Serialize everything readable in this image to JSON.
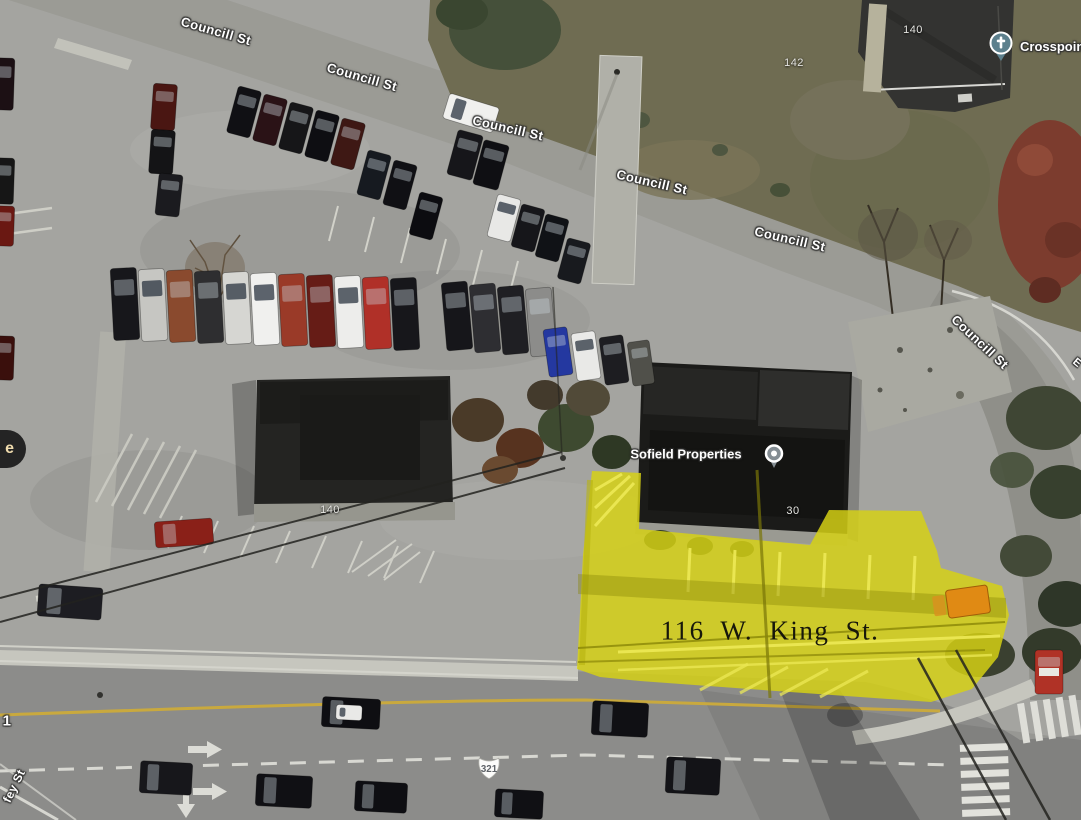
{
  "app": {
    "type": "satellite-map-view"
  },
  "highlight": {
    "label": "116 W. King St.",
    "label_x": 770,
    "label_y": 631,
    "fill": "#d6d214",
    "accent": "#e08a14"
  },
  "pois": [
    {
      "name": "Crosspoint",
      "icon": "church-pin",
      "pin_x": 988,
      "pin_y": 31,
      "label_x": 1020,
      "label_y": 39
    },
    {
      "name": "Sofield Properties",
      "icon": "place-pin",
      "pin_x": 764,
      "pin_y": 444,
      "label_x": 686,
      "label_y": 454
    }
  ],
  "route_badge": {
    "text": "321",
    "shape": "us-route-shield",
    "x": 475,
    "y": 755
  },
  "street_labels": [
    {
      "text": "Councill St",
      "x": 216,
      "y": 31,
      "rot": 16
    },
    {
      "text": "Councill St",
      "x": 362,
      "y": 77,
      "rot": 16
    },
    {
      "text": "Councill St",
      "x": 508,
      "y": 128,
      "rot": 13
    },
    {
      "text": "Councill St",
      "x": 652,
      "y": 182,
      "rot": 13
    },
    {
      "text": "Councill St",
      "x": 790,
      "y": 239,
      "rot": 13
    },
    {
      "text": "Councill St",
      "x": 980,
      "y": 342,
      "rot": 43
    },
    {
      "text": "fey St",
      "x": 14,
      "y": 786,
      "rot": -64,
      "partial": true
    }
  ],
  "address_labels": [
    {
      "text": "140",
      "x": 913,
      "y": 30
    },
    {
      "text": "142",
      "x": 794,
      "y": 63
    },
    {
      "text": "140",
      "x": 330,
      "y": 510
    },
    {
      "text": "30",
      "x": 793,
      "y": 511
    }
  ],
  "partial_labels": [
    {
      "text": "e",
      "x": 10,
      "y": 449,
      "style": "dark-pill"
    },
    {
      "text": "1",
      "x": 7,
      "y": 721,
      "style": "outlined",
      "rot": 0
    },
    {
      "text": "E",
      "x": 1077,
      "y": 363,
      "style": "outlined",
      "rot": 40
    }
  ],
  "colors": {
    "highlight_yellow": "#d6d214",
    "highlight_orange": "#e08a14",
    "road_gray": "#9b9b95",
    "label_white": "#ffffff"
  }
}
